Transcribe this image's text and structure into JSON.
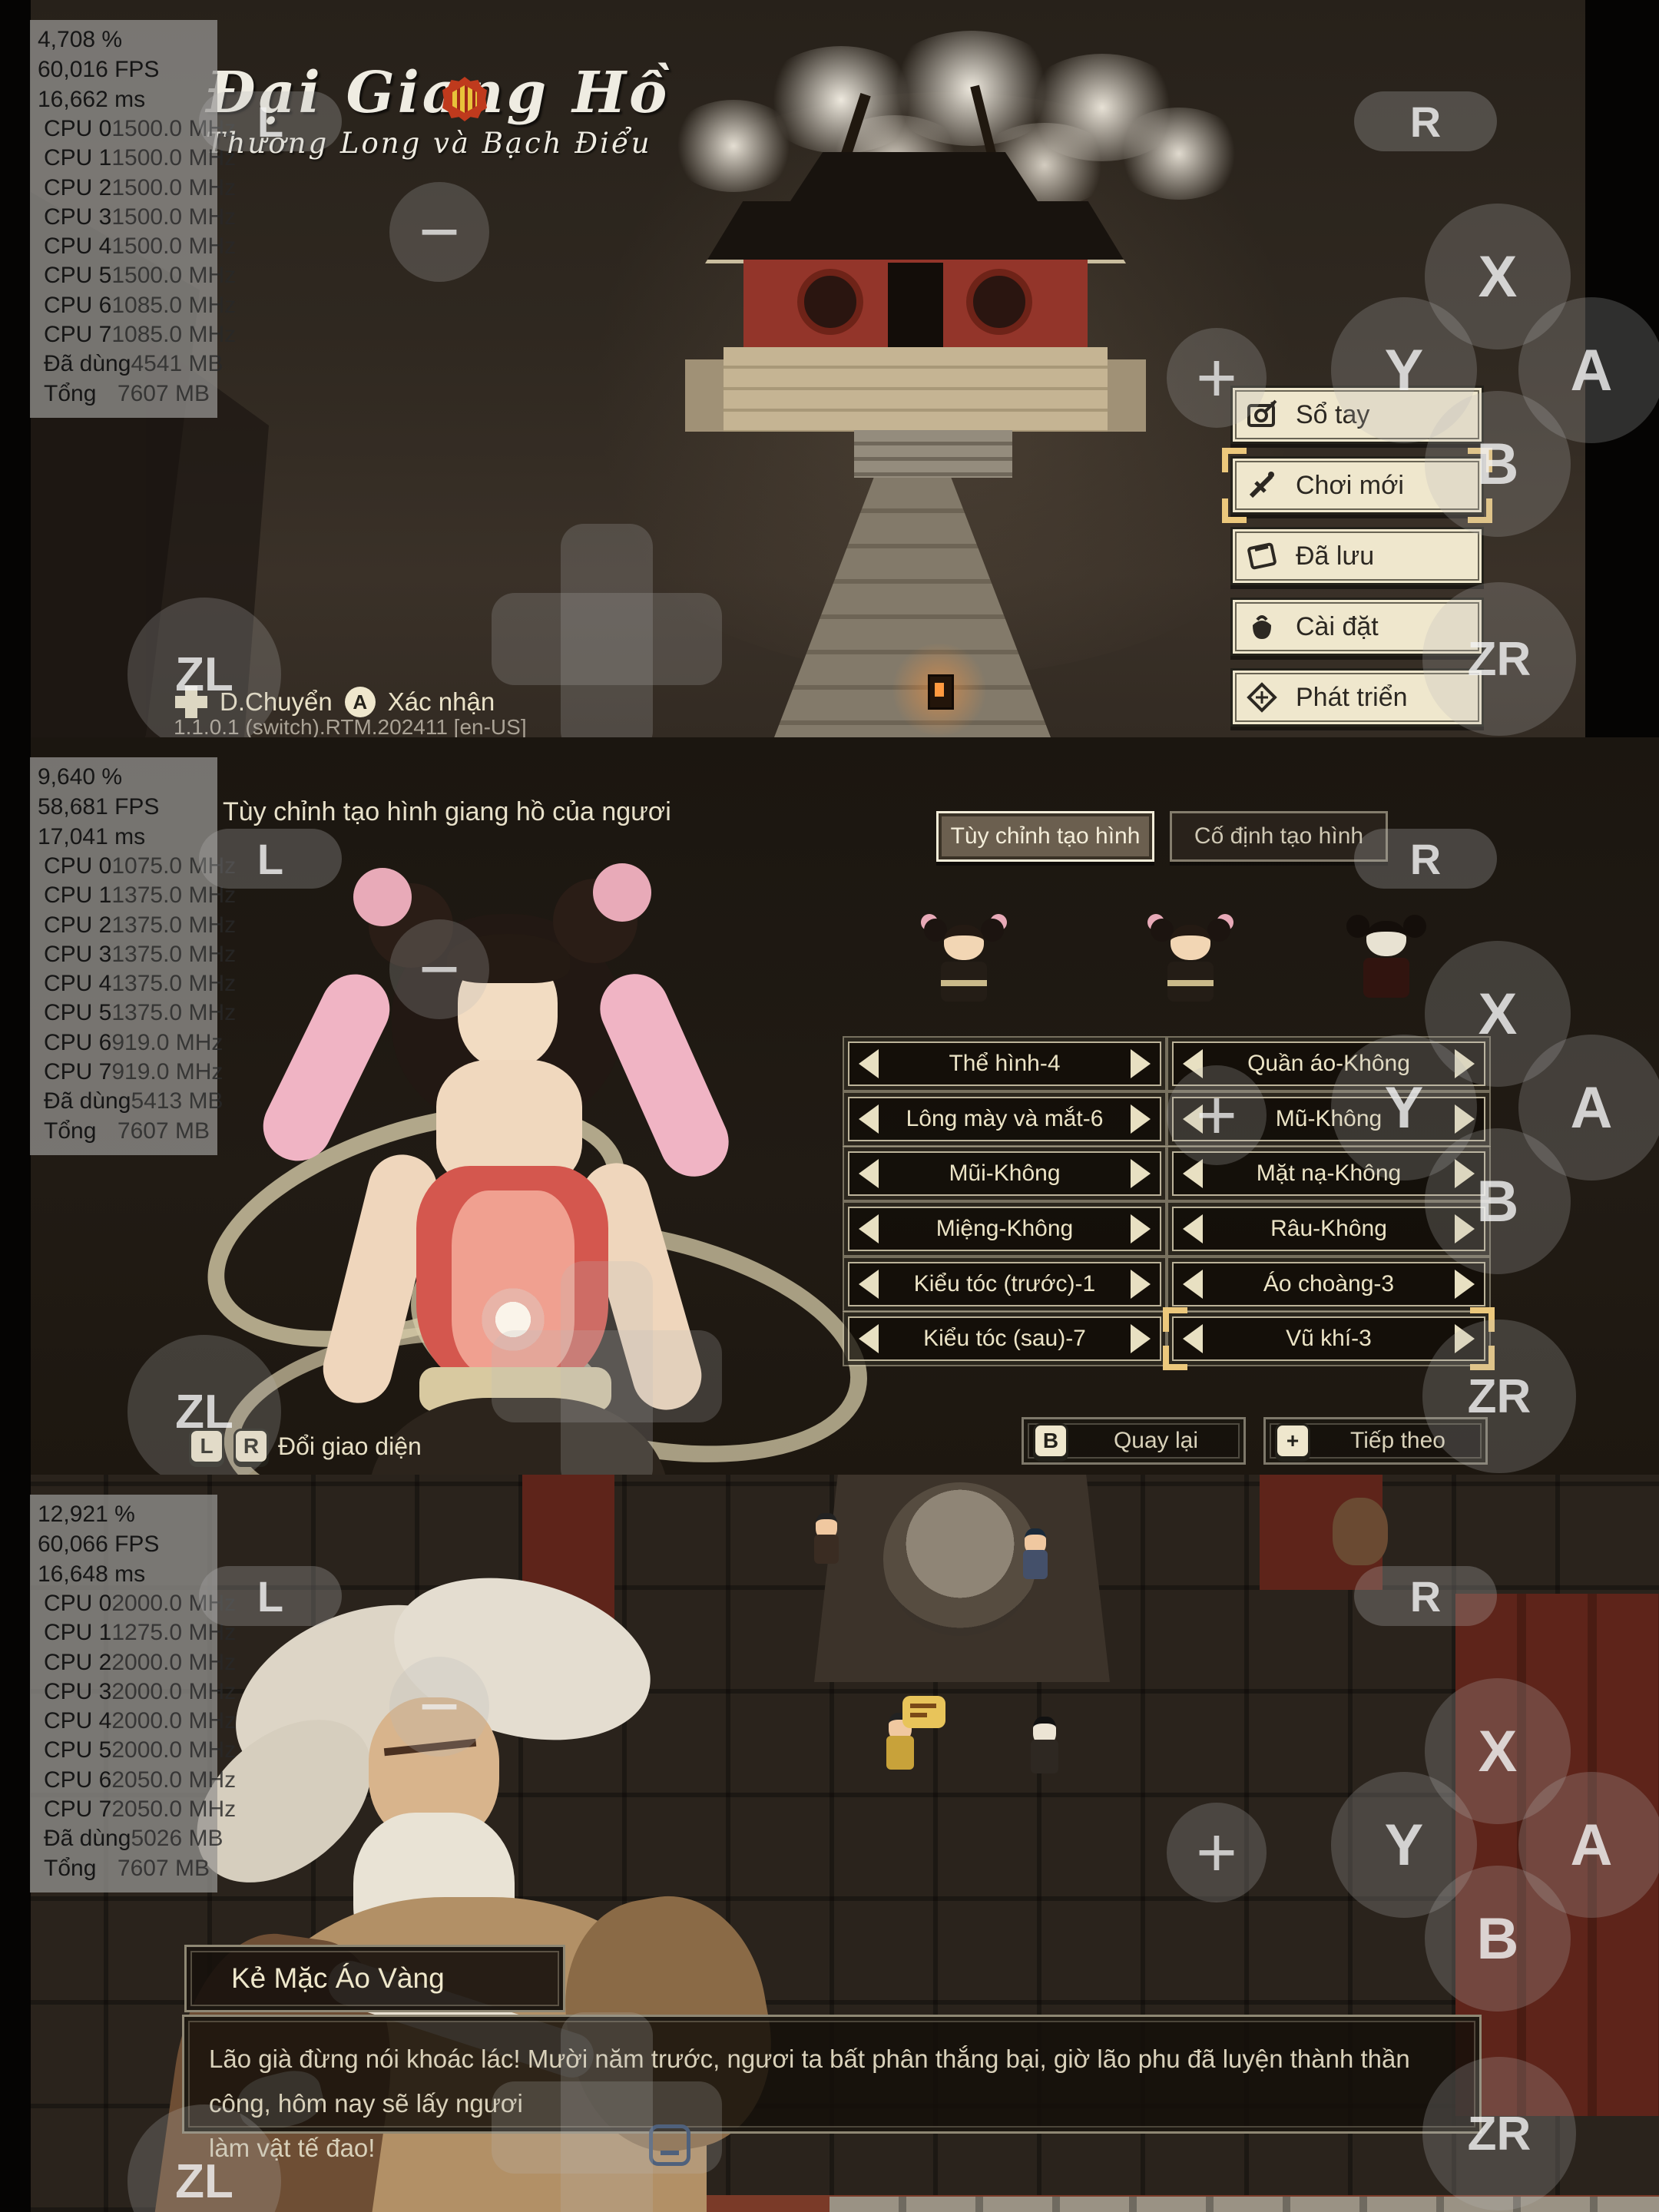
{
  "controller": {
    "l": "L",
    "r": "R",
    "zl": "ZL",
    "zr": "ZR",
    "x": "X",
    "y": "Y",
    "a": "A",
    "b": "B",
    "minus": "−",
    "plus": "+"
  },
  "panels": [
    {
      "perf": {
        "pct": "4,708 %",
        "fps": "60,016 FPS",
        "ms": "16,662 ms",
        "rows": [
          {
            "l": "CPU 0",
            "v": "1500.0 MHz"
          },
          {
            "l": "CPU 1",
            "v": "1500.0 MHz"
          },
          {
            "l": "CPU 2",
            "v": "1500.0 MHz"
          },
          {
            "l": "CPU 3",
            "v": "1500.0 MHz"
          },
          {
            "l": "CPU 4",
            "v": "1500.0 MHz"
          },
          {
            "l": "CPU 5",
            "v": "1500.0 MHz"
          },
          {
            "l": "CPU 6",
            "v": "1085.0 MHz"
          },
          {
            "l": "CPU 7",
            "v": "1085.0 MHz"
          },
          {
            "l": "Đã dùng",
            "v": "4541 MB"
          },
          {
            "l": "Tổng",
            "v": "7607 MB"
          }
        ]
      },
      "logo": {
        "title": "Đại Giang Hồ",
        "subtitle": "Thương Long và Bạch Điểu"
      },
      "menu": [
        {
          "label": "Sổ tay",
          "icon": "scroll-icon",
          "selected": false
        },
        {
          "label": "Chơi mới",
          "icon": "sword-icon",
          "selected": true
        },
        {
          "label": "Đã lưu",
          "icon": "book-icon",
          "selected": false
        },
        {
          "label": "Cài đặt",
          "icon": "bag-icon",
          "selected": false
        },
        {
          "label": "Phát triển",
          "icon": "dev-icon",
          "selected": false
        }
      ],
      "hints": {
        "dpad_label": "D.Chuyển",
        "a_key": "A",
        "a_label": "Xác nhận"
      },
      "version": "1.1.0.1 (switch).RTM.202411 [en-US]"
    },
    {
      "perf": {
        "pct": "9,640 %",
        "fps": "58,681 FPS",
        "ms": "17,041 ms",
        "rows": [
          {
            "l": "CPU 0",
            "v": "1075.0 MHz"
          },
          {
            "l": "CPU 1",
            "v": "1375.0 MHz"
          },
          {
            "l": "CPU 2",
            "v": "1375.0 MHz"
          },
          {
            "l": "CPU 3",
            "v": "1375.0 MHz"
          },
          {
            "l": "CPU 4",
            "v": "1375.0 MHz"
          },
          {
            "l": "CPU 5",
            "v": "1375.0 MHz"
          },
          {
            "l": "CPU 6",
            "v": "919.0 MHz"
          },
          {
            "l": "CPU 7",
            "v": "919.0 MHz"
          },
          {
            "l": "Đã dùng",
            "v": "5413 MB"
          },
          {
            "l": "Tổng",
            "v": "7607 MB"
          }
        ]
      },
      "title": "Tùy chỉnh tạo hình giang hồ của ngươi",
      "tabs": [
        {
          "label": "Tùy chỉnh tạo hình",
          "active": true
        },
        {
          "label": "Cố định tạo hình",
          "active": false
        }
      ],
      "selectors_left": [
        "Thể hình-4",
        "Lông mày và mắt-6",
        "Mũi-Không",
        "Miệng-Không",
        "Kiểu tóc (trước)-1",
        "Kiểu tóc (sau)-7"
      ],
      "selectors_right": [
        "Quần áo-Không",
        "Mũ-Không",
        "Mặt nạ-Không",
        "Râu-Không",
        "Áo choàng-3",
        "Vũ khí-3"
      ],
      "selected_selector": "Vũ khí-3",
      "buttons": {
        "back_key": "B",
        "back_label": "Quay lại",
        "next_key": "+",
        "next_label": "Tiếp theo"
      },
      "hint": {
        "key1": "L",
        "key2": "R",
        "label": "Đổi giao diện"
      }
    },
    {
      "perf": {
        "pct": "12,921 %",
        "fps": "60,066 FPS",
        "ms": "16,648 ms",
        "rows": [
          {
            "l": "CPU 0",
            "v": "2000.0 MHz"
          },
          {
            "l": "CPU 1",
            "v": "1275.0 MHz"
          },
          {
            "l": "CPU 2",
            "v": "2000.0 MHz"
          },
          {
            "l": "CPU 3",
            "v": "2000.0 MHz"
          },
          {
            "l": "CPU 4",
            "v": "2000.0 MHz"
          },
          {
            "l": "CPU 5",
            "v": "2000.0 MHz"
          },
          {
            "l": "CPU 6",
            "v": "2050.0 MHz"
          },
          {
            "l": "CPU 7",
            "v": "2050.0 MHz"
          },
          {
            "l": "Đã dùng",
            "v": "5026 MB"
          },
          {
            "l": "Tổng",
            "v": "7607 MB"
          }
        ]
      },
      "speaker": "Kẻ Mặc Áo Vàng",
      "dialogue_lines": [
        "Lão già đừng nói khoác lác! Mười năm trước, ngươi ta bất phân thắng bại, giờ lão phu đã luyện thành thần công, hôm nay sẽ lấy ngươi",
        "làm vật tế đao!"
      ]
    }
  ]
}
